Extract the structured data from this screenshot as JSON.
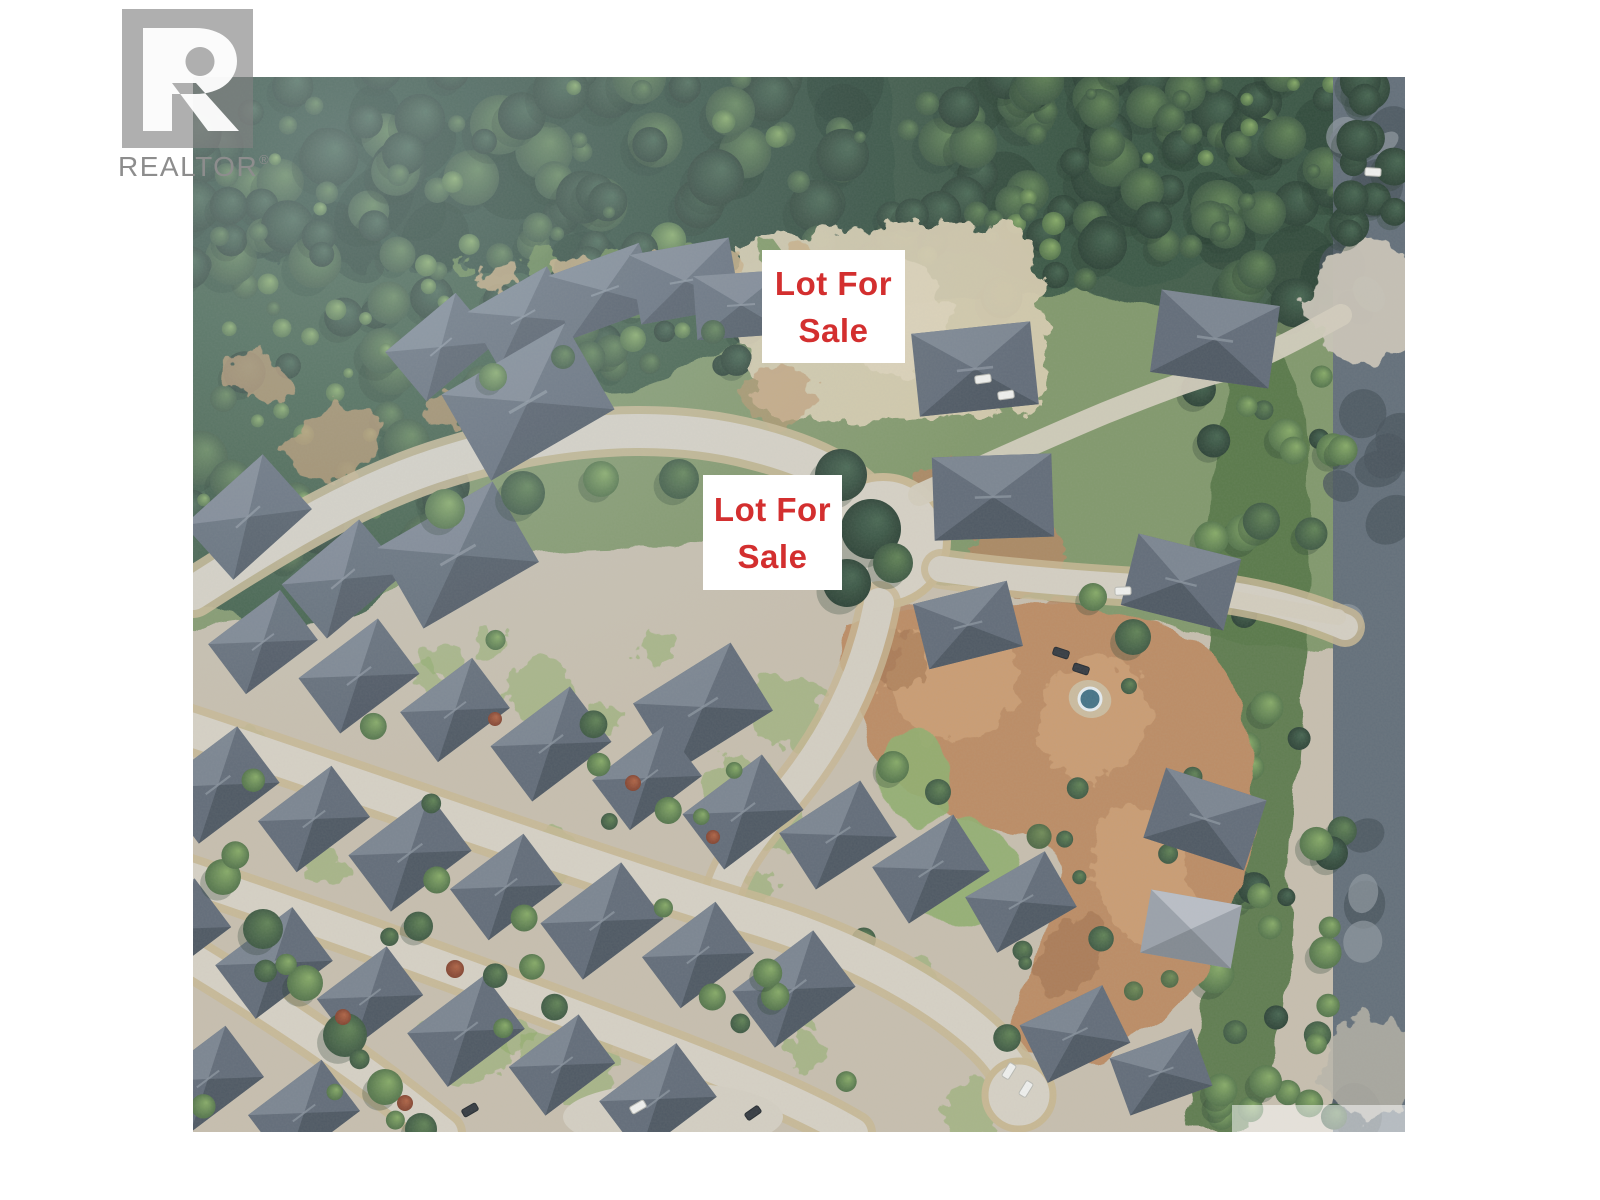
{
  "page": {
    "background": "#ffffff"
  },
  "branding": {
    "logo_text": "REALTOR",
    "registered_mark": "®",
    "logo_square_color": "#828282",
    "logo_letter_color": "#ffffff",
    "wordmark_color": "#8d8d8d"
  },
  "photo": {
    "kind": "aerial-photograph",
    "description": "Aerial view of a forested residential cul-de-sac neighbourhood with vacant lots marked for sale"
  },
  "labels": {
    "text_color": "#d32f2f",
    "box_background": "#ffffff",
    "items": [
      {
        "line1": "Lot For",
        "line2": "Sale"
      },
      {
        "line1": "Lot For",
        "line2": "Sale"
      }
    ]
  }
}
